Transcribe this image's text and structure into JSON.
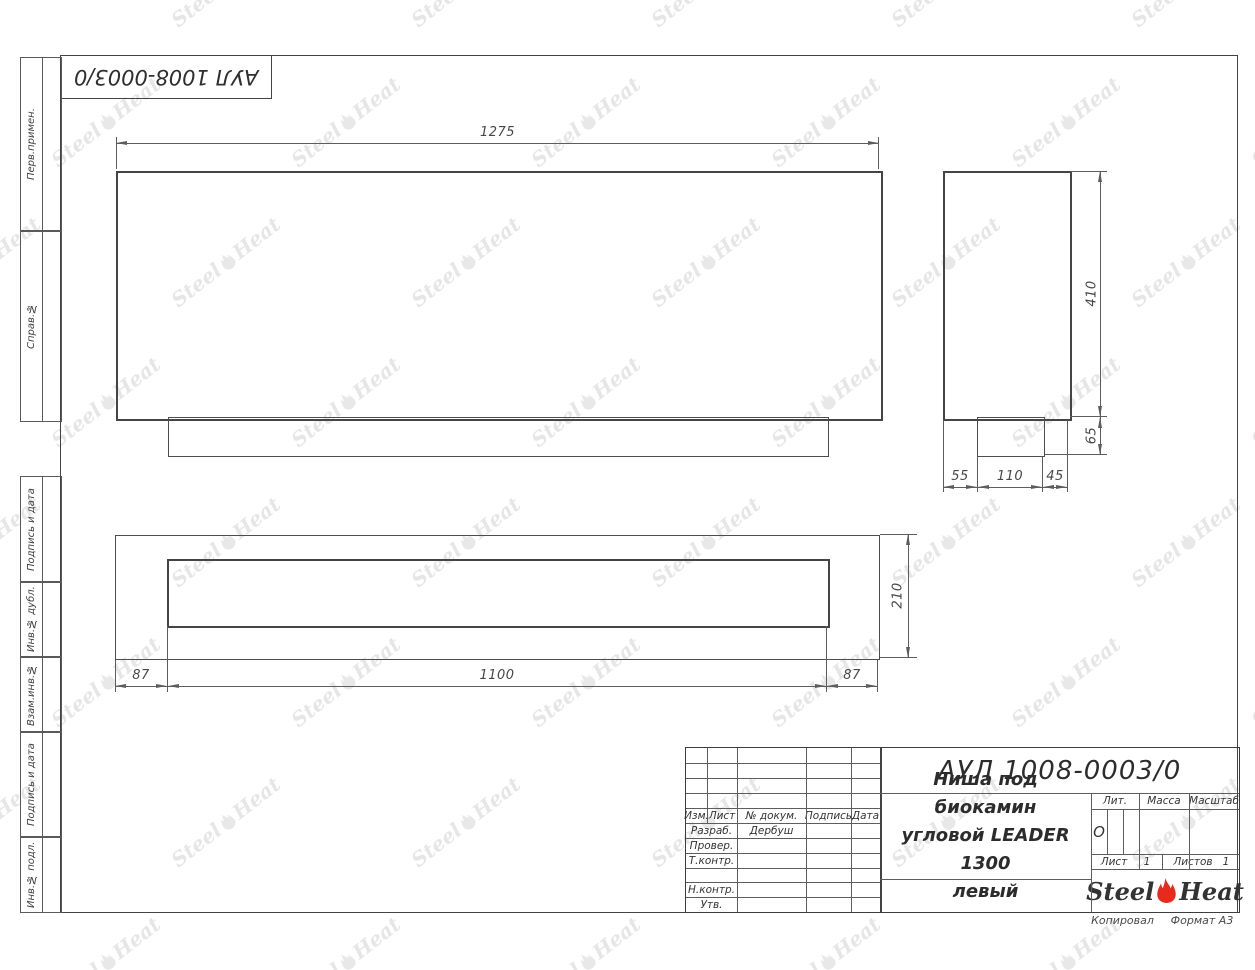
{
  "corner_stamp": {
    "doc_number": "АУЛ 1008-0003/0"
  },
  "margin_labels": [
    "Перв.примен.",
    "Справ.№",
    "Подпись и дата",
    "Инв.№ дубл.",
    "Взам.инв.№",
    "Подпись и дата",
    "Инв.№ подл."
  ],
  "dims": {
    "front_width": "1275",
    "side_height": "410",
    "side_foot_height": "65",
    "side_b1": "55",
    "side_b2": "110",
    "side_b3": "45",
    "bottom_left": "87",
    "bottom_center": "1100",
    "bottom_right": "87",
    "bottom_height": "210"
  },
  "title_block": {
    "doc_number": "АУЛ 1008-0003/0",
    "name_line1": "Ниша под биокамин",
    "name_line2": "угловой LEADER 1300",
    "name_line3": "левый",
    "col_izm": "Изм.",
    "col_list": "Лист",
    "col_ndoc": "№ докум.",
    "col_podpis": "Подпись",
    "col_data": "Дата",
    "row_razrab": "Разраб.",
    "row_razrab_value": "Дербуш",
    "row_prover": "Провер.",
    "row_tkontr": "Т.контр.",
    "row_nkontr": "Н.контр.",
    "row_utv": "Утв.",
    "lit_label": "Лит.",
    "lit_value": "О",
    "massa_label": "Масса",
    "masshtab_label": "Масштаб",
    "list_label": "Лист",
    "list_value": "1",
    "listov_label": "Листов",
    "listov_value": "1",
    "logo_steel": "Steel",
    "logo_heat": "Heat"
  },
  "footer": {
    "kopiroval": "Копировал",
    "format": "Формат А3"
  },
  "watermark": {
    "steel": "Steel",
    "heat": "Heat"
  },
  "colors": {
    "flame_red": "#e8291d",
    "outline": "#454545",
    "thin_line": "#5d5d5d",
    "watermark": "#e3e1e2"
  }
}
